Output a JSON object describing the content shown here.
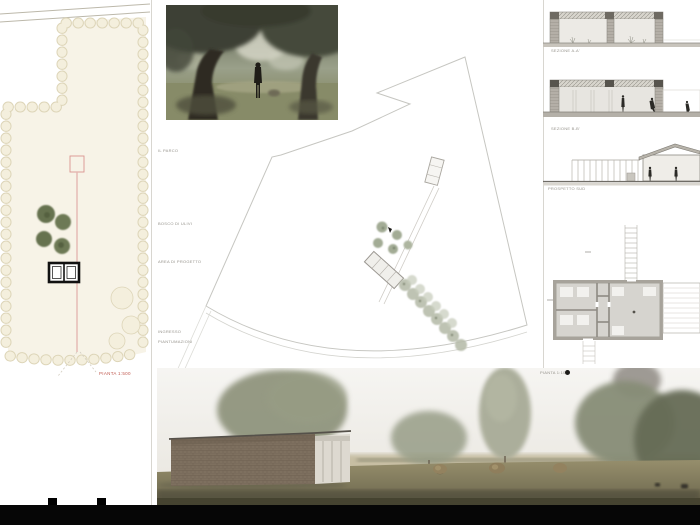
{
  "left_panel": {
    "scale_label": "PIANTA 1:500"
  },
  "middle_panel": {
    "notes": [
      {
        "label": "IL PARCO"
      },
      {
        "label": "BOSCO DI ULIVI"
      },
      {
        "label": "AREA DI PROGETTO"
      },
      {
        "label": "INGRESSO"
      },
      {
        "label": "PIANTUMAZIONI"
      }
    ]
  },
  "right_panel": {
    "drawings": [
      {
        "label": "SEZIONE A-A'"
      },
      {
        "label": "SEZIONE B-B'"
      },
      {
        "label": "PROSPETTO SUD"
      },
      {
        "label": "PIANTA 1:100"
      }
    ]
  },
  "colors": {
    "board_bg": "#ffffff",
    "plan_cream": "#f7f3e7",
    "accent_red": "#c05a50",
    "olive_green": "#66724f",
    "drawing_gray": "#a5a19a",
    "footer_black": "#060606"
  }
}
